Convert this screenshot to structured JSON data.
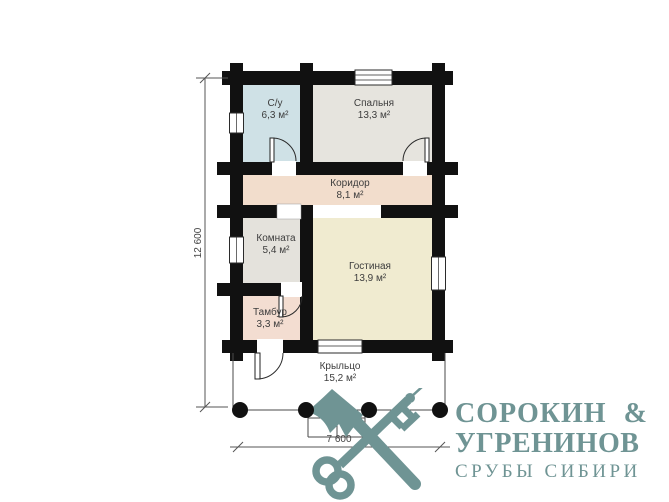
{
  "document_title": "План дома",
  "plan": {
    "rooms": [
      {
        "id": "su",
        "name": "С/у",
        "area": "6,3 м²"
      },
      {
        "id": "bedroom",
        "name": "Спальня",
        "area": "13,3 м²"
      },
      {
        "id": "corridor",
        "name": "Коридор",
        "area": "8,1 м²"
      },
      {
        "id": "room",
        "name": "Комната",
        "area": "5,4 м²"
      },
      {
        "id": "living",
        "name": "Гостиная",
        "area": "13,9 м²"
      },
      {
        "id": "tambour",
        "name": "Тамбур",
        "area": "3,3 м²"
      },
      {
        "id": "porch",
        "name": "Крыльцо",
        "area": "15,2 м²"
      }
    ],
    "dimensions": {
      "height_label": "12 600",
      "width_label": "7 600"
    },
    "colors": {
      "wall": "#111111",
      "su": "#cfe1e6",
      "bedroom": "#e6e4de",
      "corridor": "#f2ddcc",
      "room": "#e4e2dc",
      "living": "#f0ebd0",
      "tambour": "#f3ddd1",
      "porch": "#ffffff"
    }
  },
  "logo": {
    "name_line1": "СОРОКИН",
    "ampersand": "&",
    "name_line2": "УГРЕНИНОВ",
    "tagline": "СРУБЫ СИБИРИ",
    "color": "#6f9494",
    "icon": "crossed-axe-and-key"
  }
}
